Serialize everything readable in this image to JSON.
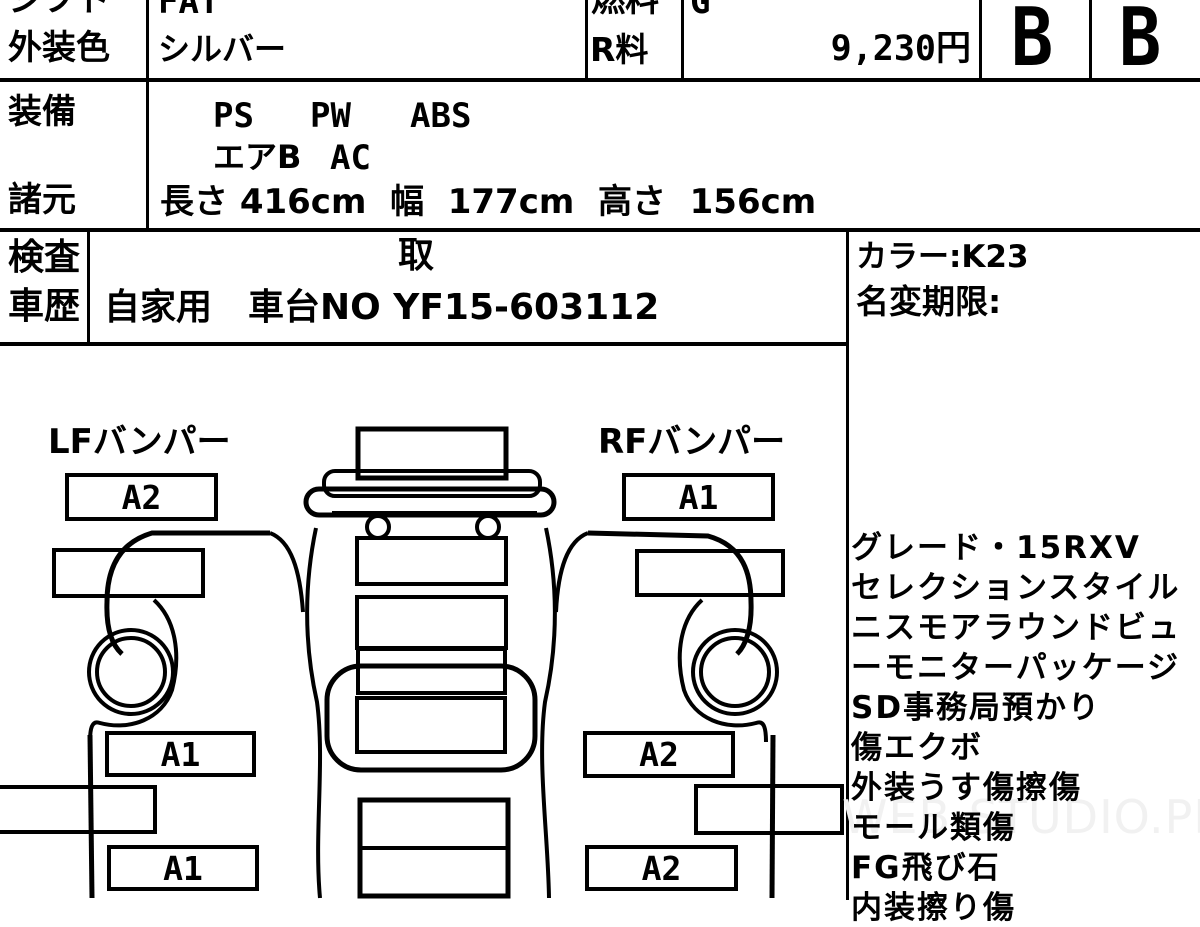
{
  "header": {
    "shift_label": "シフト",
    "shift_value": "FAT",
    "fuel_label": "燃料",
    "fuel_value": "G",
    "exterior_color_label": "外装色",
    "exterior_color_value": "シルバー",
    "recycle_fee_label": "R料",
    "recycle_fee_value": "9,230円",
    "grade_exterior": "B",
    "grade_interior": "B"
  },
  "equipment": {
    "label": "装備",
    "items_line1": [
      "PS",
      "PW",
      "ABS"
    ],
    "items_line2": [
      "エアB",
      "AC"
    ]
  },
  "dimensions": {
    "label": "諸元",
    "value": "長さ 416cm  幅  177cm  高さ  156cm"
  },
  "history": {
    "label_line1": "検査",
    "label_line2": "車歴",
    "note": "取",
    "value": "自家用　車台NO YF15-603112"
  },
  "right_panel": {
    "color_code": "カラー:K23",
    "name_change_label": "名変期限:",
    "notes": [
      "グレード・15RXV",
      "セレクションスタイル",
      "ニスモアラウンドビュ",
      "ーモニターパッケージ",
      "SD事務局預かり",
      "傷エクボ",
      "外装うす傷擦傷",
      "モール類傷",
      "FG飛び石",
      "内装擦り傷"
    ]
  },
  "diagram": {
    "lf_bumper_label": "LFバンパー",
    "lf_bumper_grade": "A2",
    "rf_bumper_label": "RFバンパー",
    "rf_bumper_grade": "A1",
    "left_door_grade": "A1",
    "left_lower_grade": "A1",
    "right_door_grade": "A2",
    "right_lower_grade": "A2"
  },
  "watermark": "WEB-STUDIO.PRO",
  "colors": {
    "ink": "#000000",
    "paper": "#ffffff",
    "watermark_gray": "#f1f1f1"
  }
}
